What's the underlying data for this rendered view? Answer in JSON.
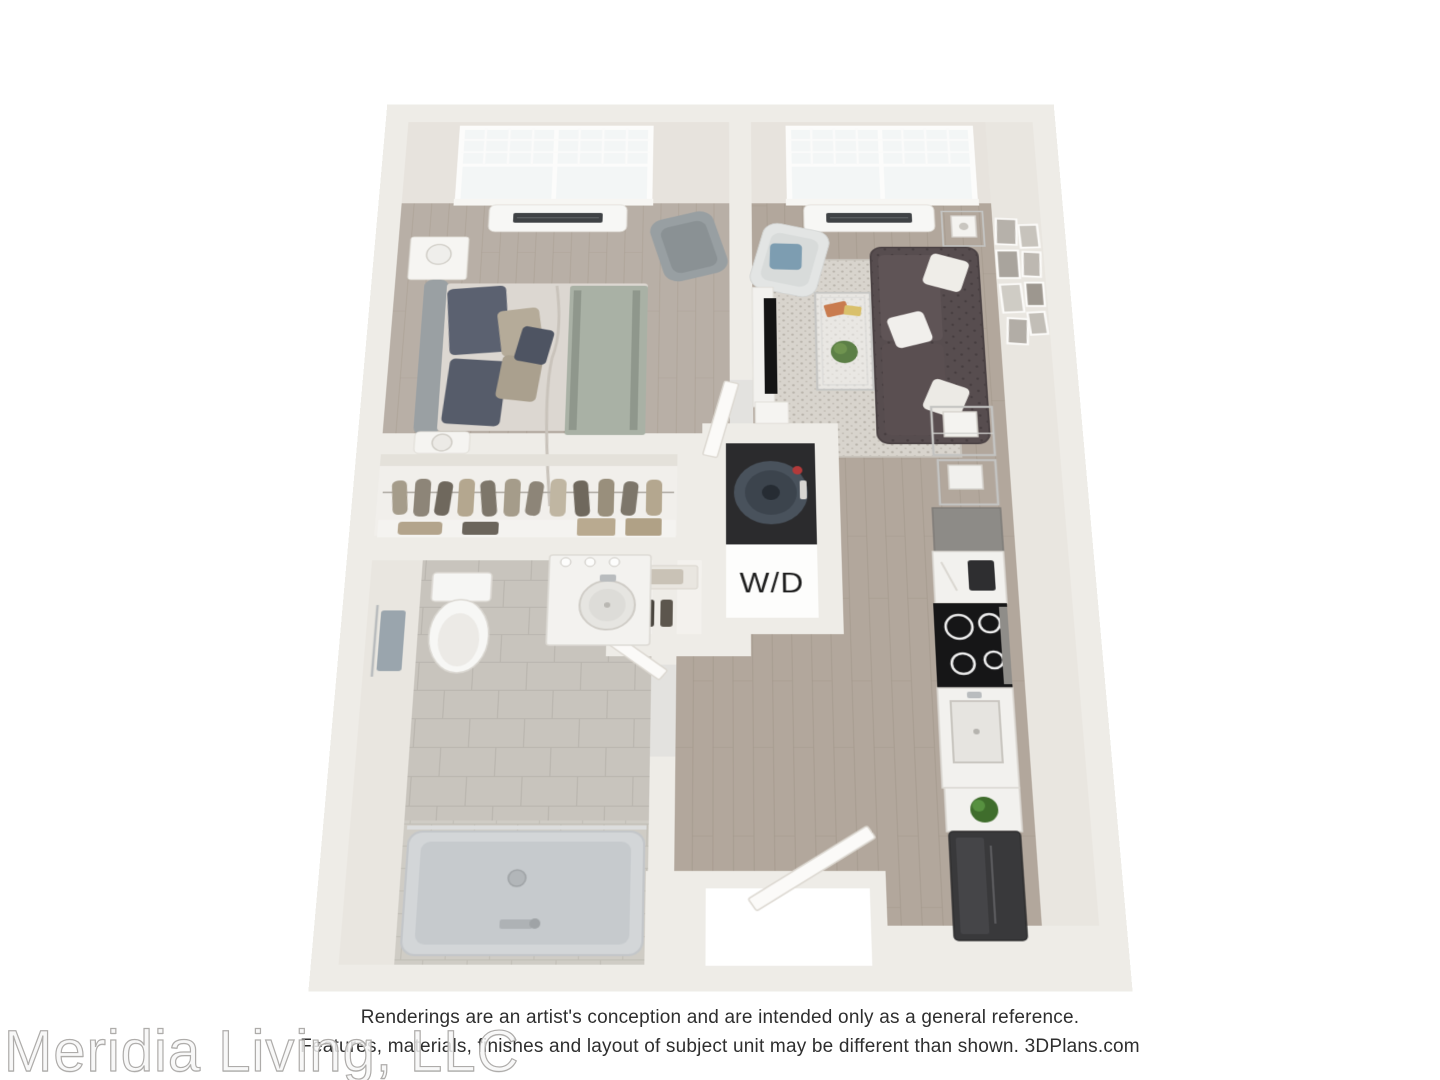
{
  "plan": {
    "wd_label": "W/D",
    "items": [
      "bed",
      "nightstand",
      "wingback-armchair",
      "wall-ac-unit",
      "double-hung-window",
      "closet-hanging-clothes",
      "toilet",
      "vanity-sink",
      "bathtub",
      "towel-rack",
      "washer-dryer-stack",
      "linen-shelves",
      "tv-console",
      "glass-coffee-table",
      "tufted-sofa",
      "white-armchair",
      "area-rug",
      "gallery-wall-frames",
      "bar-cart",
      "kitchen-cabinets",
      "coffee-maker",
      "cooktop",
      "kitchen-sink",
      "potted-plant",
      "refrigerator",
      "entry-door",
      "bathroom-door",
      "bedroom-door"
    ]
  },
  "footer": {
    "disclaimer_line1": "Renderings are an artist's conception and are intended only as a general reference.",
    "disclaimer_line2": "Features, materials, finishes and layout of subject unit may be different than shown. 3DPlans.com",
    "watermark": "Meridia Living, LLC"
  },
  "palette": {
    "wall": "#eeece7",
    "wall_face": "#e7e3dd",
    "wood_floor": "#b3a89d",
    "bedroom_floor": "#b8afa6",
    "tile_floor": "#c8c4bd",
    "rug": "#d8d4cd",
    "sofa": "#574d4f",
    "accent_pillow": "#7d9db1",
    "cabinet": "#8d8b87",
    "appliance_dark": "#39393b",
    "washer": "#49525c",
    "text": "#2e2e2e"
  }
}
